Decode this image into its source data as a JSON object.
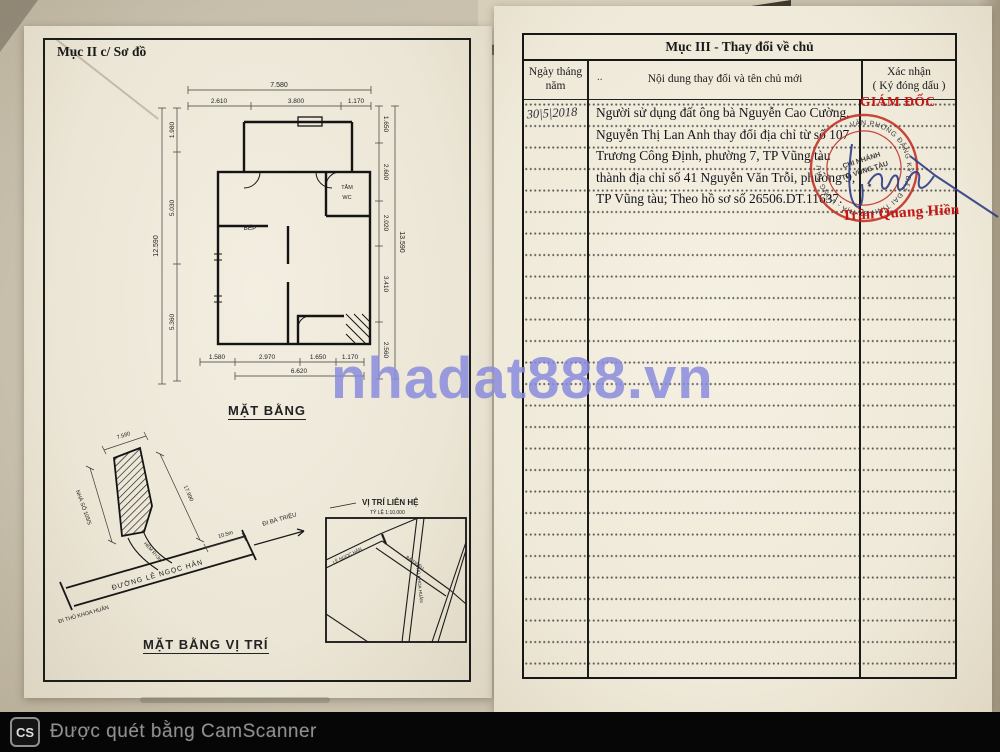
{
  "watermark": {
    "text": "nhadat888.vn",
    "color": "#898cdd"
  },
  "scanner_bar": {
    "logo_text": "CS",
    "label": "Được quét bằng CamScanner"
  },
  "left_page": {
    "section_title": "Mục II c/ Sơ đồ",
    "floor_plan": {
      "caption": "MẶT BẰNG",
      "rooms": {
        "kitchen": "BẾP",
        "bath": "TẮM",
        "wc": "WC"
      },
      "dims": {
        "top_total": "7.580",
        "top_segments": [
          "2.610",
          "3.800",
          "1.170"
        ],
        "left_outer": "12.590",
        "left_segments": [
          "1.980",
          "5.030",
          "5.360"
        ],
        "right_outer": "13.590",
        "right_segments": [
          "1.650",
          "2.600",
          "2.020",
          "3.410",
          "2.560"
        ],
        "bottom_segments": [
          "1.580",
          "2.970",
          "1.650",
          "1.170"
        ],
        "bottom_total": "6.620"
      }
    },
    "site_plan": {
      "caption": "MẶT BẰNG VỊ TRÍ",
      "road_label": "ĐƯỜNG LÊ NGỌC HÂN",
      "dir_left": "ĐI THỦ KHOA HUÂN",
      "dir_right": "ĐI BÀ TRIỆU",
      "house_label": "NHÀ SỐ 105/5",
      "lane_label": "HẺM R=3m",
      "dim_top": "7.580",
      "dim_long": "17.990",
      "dim_road": "10.5m"
    },
    "inset_map": {
      "title": "VỊ TRÍ LIÊN HỆ",
      "scale": "TỶ LỆ 1:10.000",
      "roads": [
        "LÊ NGỌC HÂN",
        "BÀ TRIỆU",
        "THỦ KHOA HUÂN"
      ]
    }
  },
  "right_page": {
    "section_title": "Mục III - Thay đổi về chủ",
    "columns": {
      "date": "Ngày tháng năm",
      "content": "Nội dung thay đổi và tên chủ mới",
      "confirm_line1": "Xác nhận",
      "confirm_line2": "( Ký đóng dấu )"
    },
    "content_marker": "..",
    "entry": {
      "date": "30|5|2018",
      "lines": [
        "Người sử dụng đất ông bà Nguyễn Cao Cường,",
        "Nguyễn Thị Lan Anh thay đổi địa chỉ từ số 107",
        "Trương Công Định, phường 7, TP Vũng tàu",
        "thành địa chỉ số 41 Nguyễn Văn Trỗi, phường 9,",
        "TP Vũng tàu; Theo hồ sơ số 26506.DT.11637."
      ],
      "approver_title": "GIÁM ĐỐC",
      "approver_name": "Trần Quang Hiền",
      "stamp": {
        "ring_text": "VĂN PHÒNG ĐĂNG KÝ ĐẤT ĐAI TỈNH BÀ RỊA - VŨNG TÀU ✶",
        "center_line1": "CHI NHÁNH",
        "center_line2": "TP. VŨNG TÀU",
        "star": "★"
      }
    }
  },
  "colors": {
    "stamp_red": "#c0281e",
    "ink_blue": "#2c3d85",
    "accent_red": "#c41714"
  }
}
